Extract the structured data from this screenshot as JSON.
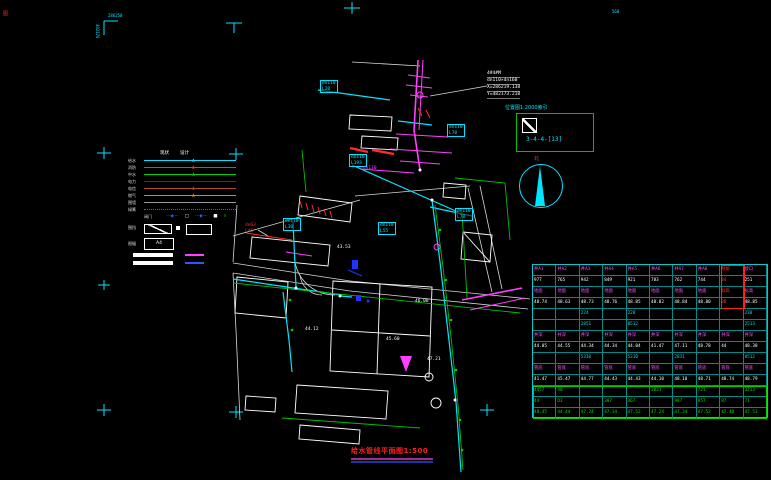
{
  "frame": {
    "corner_text_h": "286250",
    "corner_text_v": "482170",
    "corner_glyph": "图",
    "grid_label": "568"
  },
  "title": {
    "text": "给水管线平面图1:500"
  },
  "north": {
    "label": "北"
  },
  "index_box": {
    "caption": "位置图1:2000索引",
    "ref": "3-4-4-[13]"
  },
  "annotation": {
    "lines": [
      "4#4#M",
      "dn110×dn160",
      "X=286219.138",
      "Y=482173.218"
    ]
  },
  "legend": {
    "headers": [
      "现状",
      "设计"
    ],
    "rows": [
      {
        "label": "给水",
        "color": "#00e5ff",
        "style": "solid",
        "marker": "▲"
      },
      {
        "label": "消防",
        "color": "#ff2a2a",
        "style": "solid",
        "marker": "▲"
      },
      {
        "label": "中水",
        "color": "#00d000",
        "style": "solid",
        "marker": "▲"
      },
      {
        "label": "电力",
        "color": "#9b1010",
        "style": "solid",
        "marker": ""
      },
      {
        "label": "电信",
        "color": "#b24a2a",
        "style": "solid",
        "marker": "▲"
      },
      {
        "label": "燃气",
        "color": "#e08a00",
        "style": "solid",
        "marker": "▲"
      },
      {
        "label": "围墙",
        "color": "#9c9c9c",
        "style": "solid",
        "marker": ""
      },
      {
        "label": "绿篱",
        "color": "#00b000",
        "style": "dotted",
        "marker": ""
      }
    ],
    "symbol_row": {
      "label": "阀门",
      "items": [
        "—◆—",
        "□",
        "—◆—",
        "■",
        "¤"
      ]
    },
    "box_row": {
      "label": "围挡"
    },
    "a4_row": {
      "label": "图幅",
      "box_text": "A4"
    },
    "accent_colors": {
      "bar1_line": "#ff40ff",
      "bar2_line": "#3355ff"
    }
  },
  "map": {
    "labels": [
      {
        "lines": [
          "dn110",
          "L20"
        ],
        "x": 320,
        "y": 80,
        "color": "#00e5ff",
        "boxed": true
      },
      {
        "lines": [
          "dn110",
          "L70"
        ],
        "x": 447,
        "y": 124,
        "color": "#00e5ff",
        "boxed": true
      },
      {
        "lines": [
          "dn110",
          "L193"
        ],
        "x": 349,
        "y": 154,
        "color": "#00e5ff",
        "boxed": true
      },
      {
        "lines": [
          "dn110",
          "L30"
        ],
        "x": 283,
        "y": 218,
        "color": "#00e5ff",
        "boxed": true
      },
      {
        "lines": [
          "dn110",
          "L55"
        ],
        "x": 378,
        "y": 222,
        "color": "#00e5ff",
        "boxed": true
      },
      {
        "lines": [
          "dn63",
          "L45"
        ],
        "x": 245,
        "y": 223,
        "color": "#ff2a2a",
        "boxed": false
      },
      {
        "lines": [
          "dn110",
          "L78"
        ],
        "x": 455,
        "y": 208,
        "color": "#00e5ff",
        "boxed": true
      },
      {
        "lines": [
          "dn110"
        ],
        "x": 363,
        "y": 166,
        "color": "#ff40ff",
        "boxed": false
      },
      {
        "lines": [
          "43.53"
        ],
        "x": 337,
        "y": 245,
        "color": "#ffffff",
        "boxed": false
      },
      {
        "lines": [
          "44.12"
        ],
        "x": 305,
        "y": 327,
        "color": "#ffffff",
        "boxed": false
      },
      {
        "lines": [
          "45.60"
        ],
        "x": 386,
        "y": 337,
        "color": "#ffffff",
        "boxed": false
      },
      {
        "lines": [
          "46.08"
        ],
        "x": 415,
        "y": 299,
        "color": "#ffffff",
        "boxed": false
      },
      {
        "lines": [
          "47.21"
        ],
        "x": 427,
        "y": 357,
        "color": "#ffffff",
        "boxed": false
      }
    ]
  },
  "table": {
    "grid_color": "#00cccc",
    "red_color": "#ff3030",
    "rows": [
      {
        "color": "#ff4cff",
        "cells": [
          "井A1",
          "井A2",
          "井A3",
          "井A4",
          "井A5",
          "井A6",
          "井A7",
          "井A8",
          "预留",
          "接口"
        ]
      },
      {
        "color": "#ffffff",
        "cells": [
          "977",
          "765",
          "942",
          "849",
          "921",
          "783",
          "762",
          "744",
          "84",
          "251"
        ]
      },
      {
        "color": "#ff4cff",
        "cells": [
          "地面",
          "地面",
          "地面",
          "地面",
          "地面",
          "地面",
          "地面",
          "地面",
          "标高",
          "标高"
        ]
      },
      {
        "color": "#ffffff",
        "cells": [
          "48.74",
          "48.63",
          "48.73",
          "48.76",
          "48.85",
          "48.82",
          "48.84",
          "48.80",
          "88",
          "48.85"
        ]
      },
      {
        "color": "#00dddd",
        "cells": [
          "",
          "",
          "224",
          "",
          "228",
          "",
          "",
          "",
          "",
          "238"
        ]
      },
      {
        "color": "#00dddd",
        "cells": [
          "",
          "",
          "2851",
          "",
          "8512",
          "",
          "",
          "",
          "",
          "2513"
        ]
      },
      {
        "color": "#ff4cff",
        "cells": [
          "井深",
          "井深",
          "井深",
          "井深",
          "井深",
          "井深",
          "井深",
          "井深",
          "井深",
          "井深"
        ]
      },
      {
        "color": "#ffffff",
        "cells": [
          "44.05",
          "44.55",
          "44.34",
          "44.34",
          "44.04",
          "41.47",
          "47.11",
          "48.78",
          "44",
          "48.38"
        ]
      },
      {
        "color": "#00dddd",
        "cells": [
          "",
          "",
          "5310",
          "",
          "5310",
          "",
          "2831",
          "",
          "",
          "8512"
        ]
      },
      {
        "color": "#ff4cff",
        "cells": [
          "管底",
          "管底",
          "管底",
          "管底",
          "管底",
          "管底",
          "管底",
          "管底",
          "管底",
          "管底"
        ]
      },
      {
        "color": "#ffffff",
        "cells": [
          "41.47",
          "45.47",
          "44.77",
          "44.43",
          "44.43",
          "44.10",
          "48.10",
          "48.71",
          "48.74",
          "48.79"
        ]
      },
      {
        "color": "#00dd00",
        "cells": [
          "4457",
          "40",
          "",
          "",
          "",
          "2831",
          "",
          "721",
          "",
          "3213"
        ]
      },
      {
        "color": "#00dd00",
        "cells": [
          "44",
          "D3",
          "",
          "307",
          "367",
          "",
          "987",
          "957",
          "87",
          "71"
        ]
      },
      {
        "color": "#00dd00",
        "cells": [
          "48.45",
          "44.44",
          "47.24",
          "47.34",
          "47.52",
          "47.24",
          "47.34",
          "47.52",
          "47.48",
          "47.53"
        ]
      }
    ]
  }
}
